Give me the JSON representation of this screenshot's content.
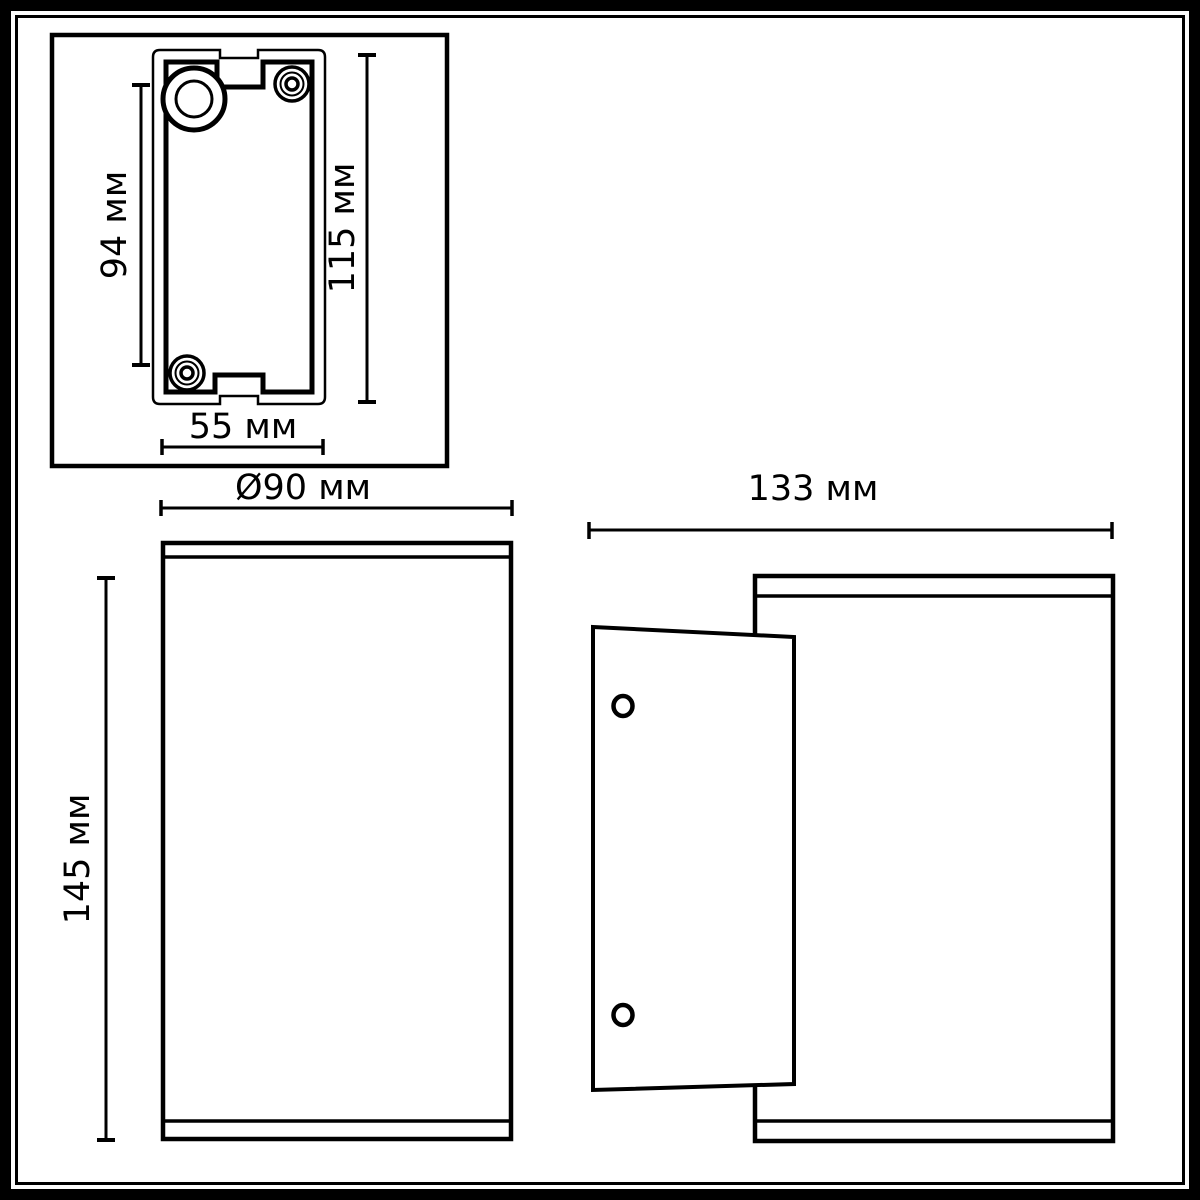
{
  "diagram": {
    "colors": {
      "line": "#000000",
      "background": "#ffffff"
    },
    "detail_view": {
      "dim_inner_height": "94 мм",
      "dim_outer_height": "115 мм",
      "dim_width": "55 мм"
    },
    "front_view": {
      "dim_diameter": "Ø90 мм",
      "dim_height": "145 мм"
    },
    "side_view": {
      "dim_depth": "133 мм"
    }
  }
}
